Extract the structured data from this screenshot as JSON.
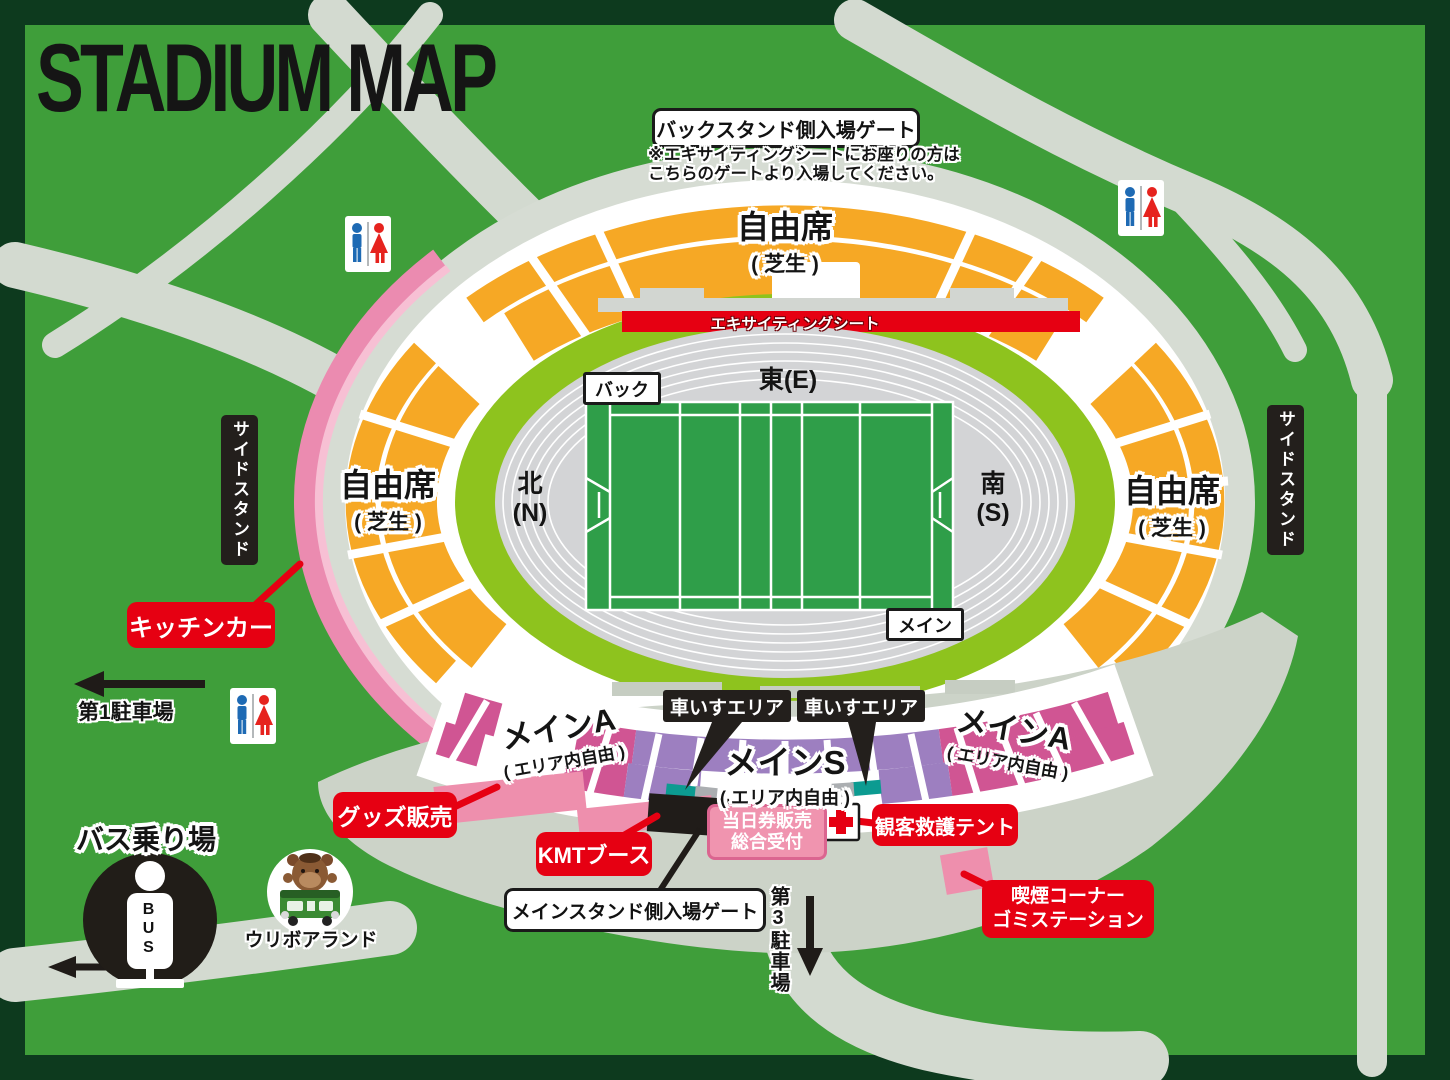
{
  "title": "STADIUM MAP",
  "colors": {
    "background_green": "#3f9e3a",
    "frame_green": "#0d3a1e",
    "road_gray": "#d3dad0",
    "seat_orange": "#f6a825",
    "seat_magenta": "#d05593",
    "seat_purple": "#9d7fc0",
    "wheelchair_teal": "#0c9b91",
    "accent_red": "#e60012",
    "pink_band": "#eb8bb0",
    "field_green": "#2f9e49",
    "track_gray": "#d3d4d6",
    "inner_ring_green": "#8ec31e",
    "apron_gray": "#ccd3c8"
  },
  "gates": {
    "back_gate": "バックスタンド側入場ゲート",
    "back_gate_note_1": "※エキサイティングシートにお座りの方は",
    "back_gate_note_2": "こちらのゲートより入場してください。",
    "main_gate": "メインスタンド側入場ゲート"
  },
  "seating": {
    "free_seat": "自由席",
    "free_seat_sub": "( 芝生 )",
    "exciting_seat": "エキサイティングシート",
    "main_a": "メインA",
    "main_s": "メインS",
    "area_free_sub": "( エリア内自由 )",
    "wheelchair_area": "車いすエリア",
    "side_stand": "サイドスタンド"
  },
  "field": {
    "east": "東(E)",
    "north_jp": "北",
    "north_en": "(N)",
    "south_jp": "南",
    "south_en": "(S)",
    "back_label": "バック",
    "main_label": "メイン"
  },
  "facilities": {
    "kitchen_car": "キッチンカー",
    "goods_sale": "グッズ販売",
    "kmt_booth": "KMTブース",
    "ticket_line_1": "当日券販売",
    "ticket_line_2": "総合受付",
    "rescue_tent": "観客救護テント",
    "smoking_line_1": "喫煙コーナー",
    "smoking_line_2": "ゴミステーション",
    "mascot_land": "ウリボアランド",
    "bus_stop": "バス乗り場",
    "bus_sign_text": "BUS"
  },
  "parking": {
    "parking_1": "第1駐車場",
    "parking_3": "第3駐車場"
  }
}
